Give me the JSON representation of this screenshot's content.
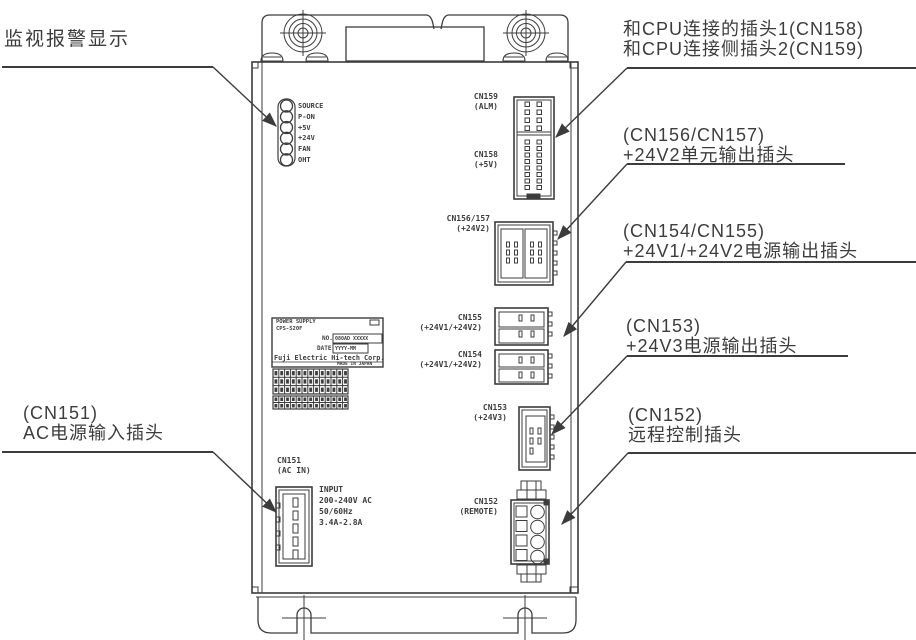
{
  "callouts": {
    "monitor_alarm": {
      "text": "监视报警显示"
    },
    "cpu": {
      "line1": "和CPU连接的插头1(CN158)",
      "line2": "和CPU连接侧插头2(CN159)"
    },
    "cn156_157": {
      "line1": "(CN156/CN157)",
      "line2": "+24V2单元输出插头"
    },
    "cn154_155": {
      "line1": "(CN154/CN155)",
      "line2": "+24V1/+24V2电源输出插头"
    },
    "cn153": {
      "line1": "(CN153)",
      "line2": "+24V3电源输出插头"
    },
    "cn152": {
      "line1": "(CN152)",
      "line2": "远程控制插头"
    },
    "cn151": {
      "line1": "(CN151)",
      "line2": "AC电源输入插头"
    }
  },
  "led_panel": {
    "labels": [
      "SOURCE",
      "P-ON",
      "+5V",
      "+24V",
      "FAN",
      "OHT"
    ]
  },
  "connector_labels": {
    "cn159": {
      "name": "CN159",
      "sub": "(ALM)"
    },
    "cn158": {
      "name": "CN158",
      "sub": "(+5V)"
    },
    "cn156_157": {
      "name": "CN156/157",
      "sub": "(+24V2)"
    },
    "cn155": {
      "name": "CN155",
      "sub": "(+24V1/+24V2)"
    },
    "cn154": {
      "name": "CN154",
      "sub": "(+24V1/+24V2)"
    },
    "cn153": {
      "name": "CN153",
      "sub": "(+24V3)"
    },
    "cn152": {
      "name": "CN152",
      "sub": "(REMOTE)"
    },
    "cn151": {
      "name": "CN151",
      "sub": "(AC IN)"
    }
  },
  "input_rating": {
    "lines": [
      "INPUT",
      "200-240V AC",
      "50/60Hz",
      "3.4A-2.8A"
    ]
  },
  "nameplate": {
    "line1": "POWER SUPPLY",
    "line2": "CPS-520F",
    "no_label": "NO.",
    "no_value": "080AD XXXXX",
    "date_label": "DATE",
    "date_value": "YYYY-MM",
    "company": "Fuji Electric Hi-tech Corp.",
    "origin": "MADE IN JAPAN"
  },
  "colors": {
    "line": "#3c3c3c",
    "text": "#3c3c3c",
    "background": "#ffffff"
  }
}
